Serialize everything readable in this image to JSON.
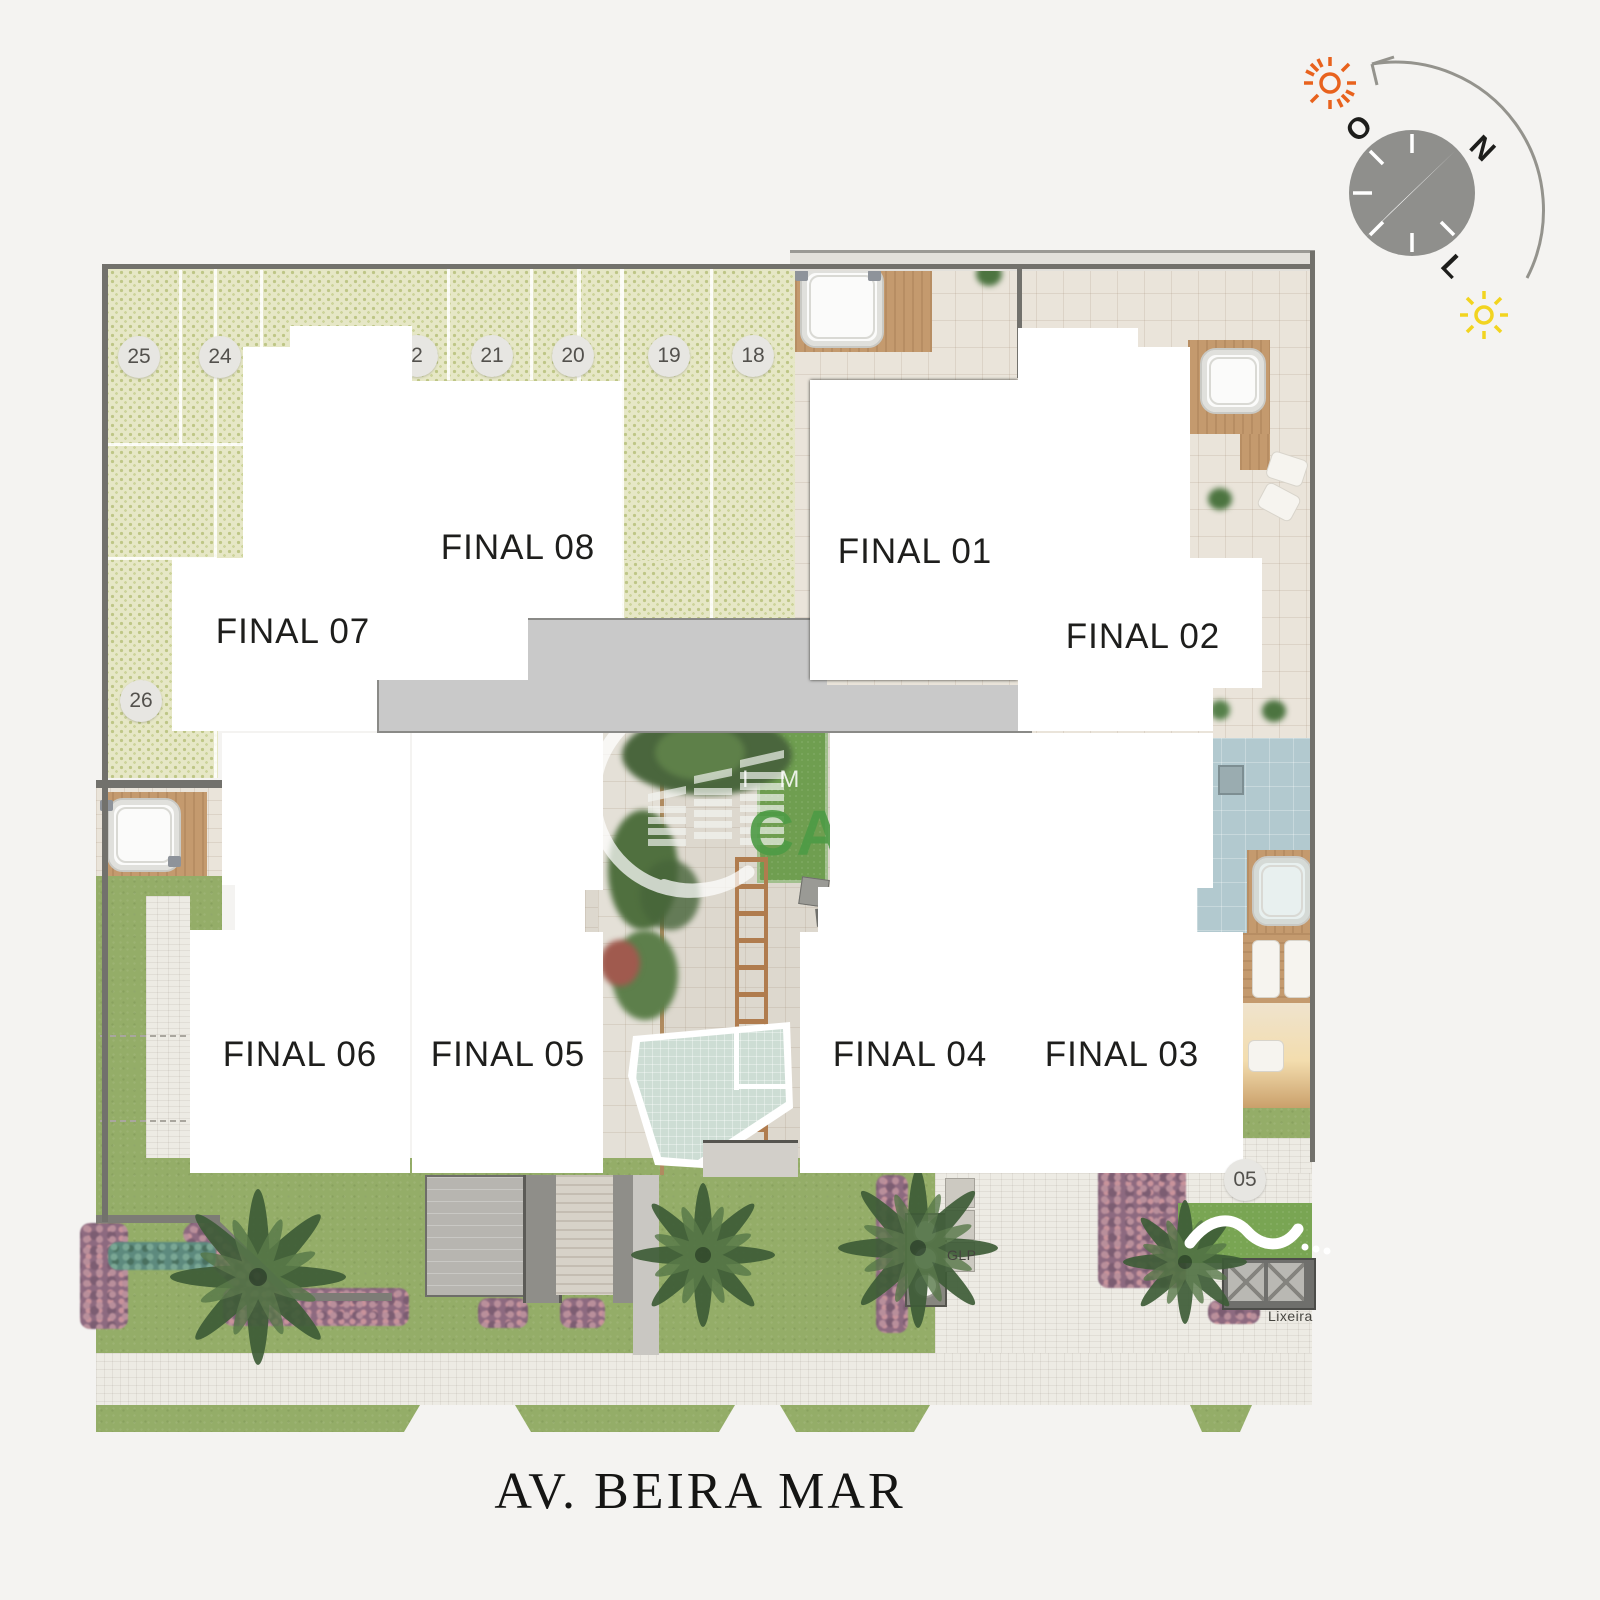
{
  "site": {
    "street_label": "AV. BEIRA MAR",
    "units": [
      {
        "label": "FINAL 01"
      },
      {
        "label": "FINAL 02"
      },
      {
        "label": "FINAL 03"
      },
      {
        "label": "FINAL 04"
      },
      {
        "label": "FINAL 05"
      },
      {
        "label": "FINAL 06"
      },
      {
        "label": "FINAL 07"
      },
      {
        "label": "FINAL 08"
      }
    ],
    "parking_spots": [
      {
        "label": "25"
      },
      {
        "label": "24"
      },
      {
        "label": "2"
      },
      {
        "label": "21"
      },
      {
        "label": "20"
      },
      {
        "label": "19"
      },
      {
        "label": "18"
      },
      {
        "label": "26"
      },
      {
        "label": "05"
      }
    ],
    "service_labels": {
      "gas": "GLP",
      "trash": "Lixeira"
    }
  },
  "compass": {
    "north": "N",
    "west": "O",
    "east": "L"
  },
  "watermark": {
    "line1": "I M Ó",
    "line2": "CA"
  },
  "colors": {
    "background": "#f4f3f1",
    "unit_fill": "#ffffff",
    "unit_border": "#33332f",
    "corridor": "#c9c9c9",
    "grass_paver": "#e6e7c6",
    "lawn": "#94ad68",
    "turf": "#6f9e50",
    "terrace_tile": "#eae4da",
    "pool": "#cdddd4",
    "spa_blue": "#b2c9cf",
    "deck_wood": "#c49a6e",
    "hedge_purple": "#8d6a80",
    "sun_orange": "#e8621d",
    "sun_yellow": "#f2d41f",
    "watermark_green": "#4d9b45"
  }
}
